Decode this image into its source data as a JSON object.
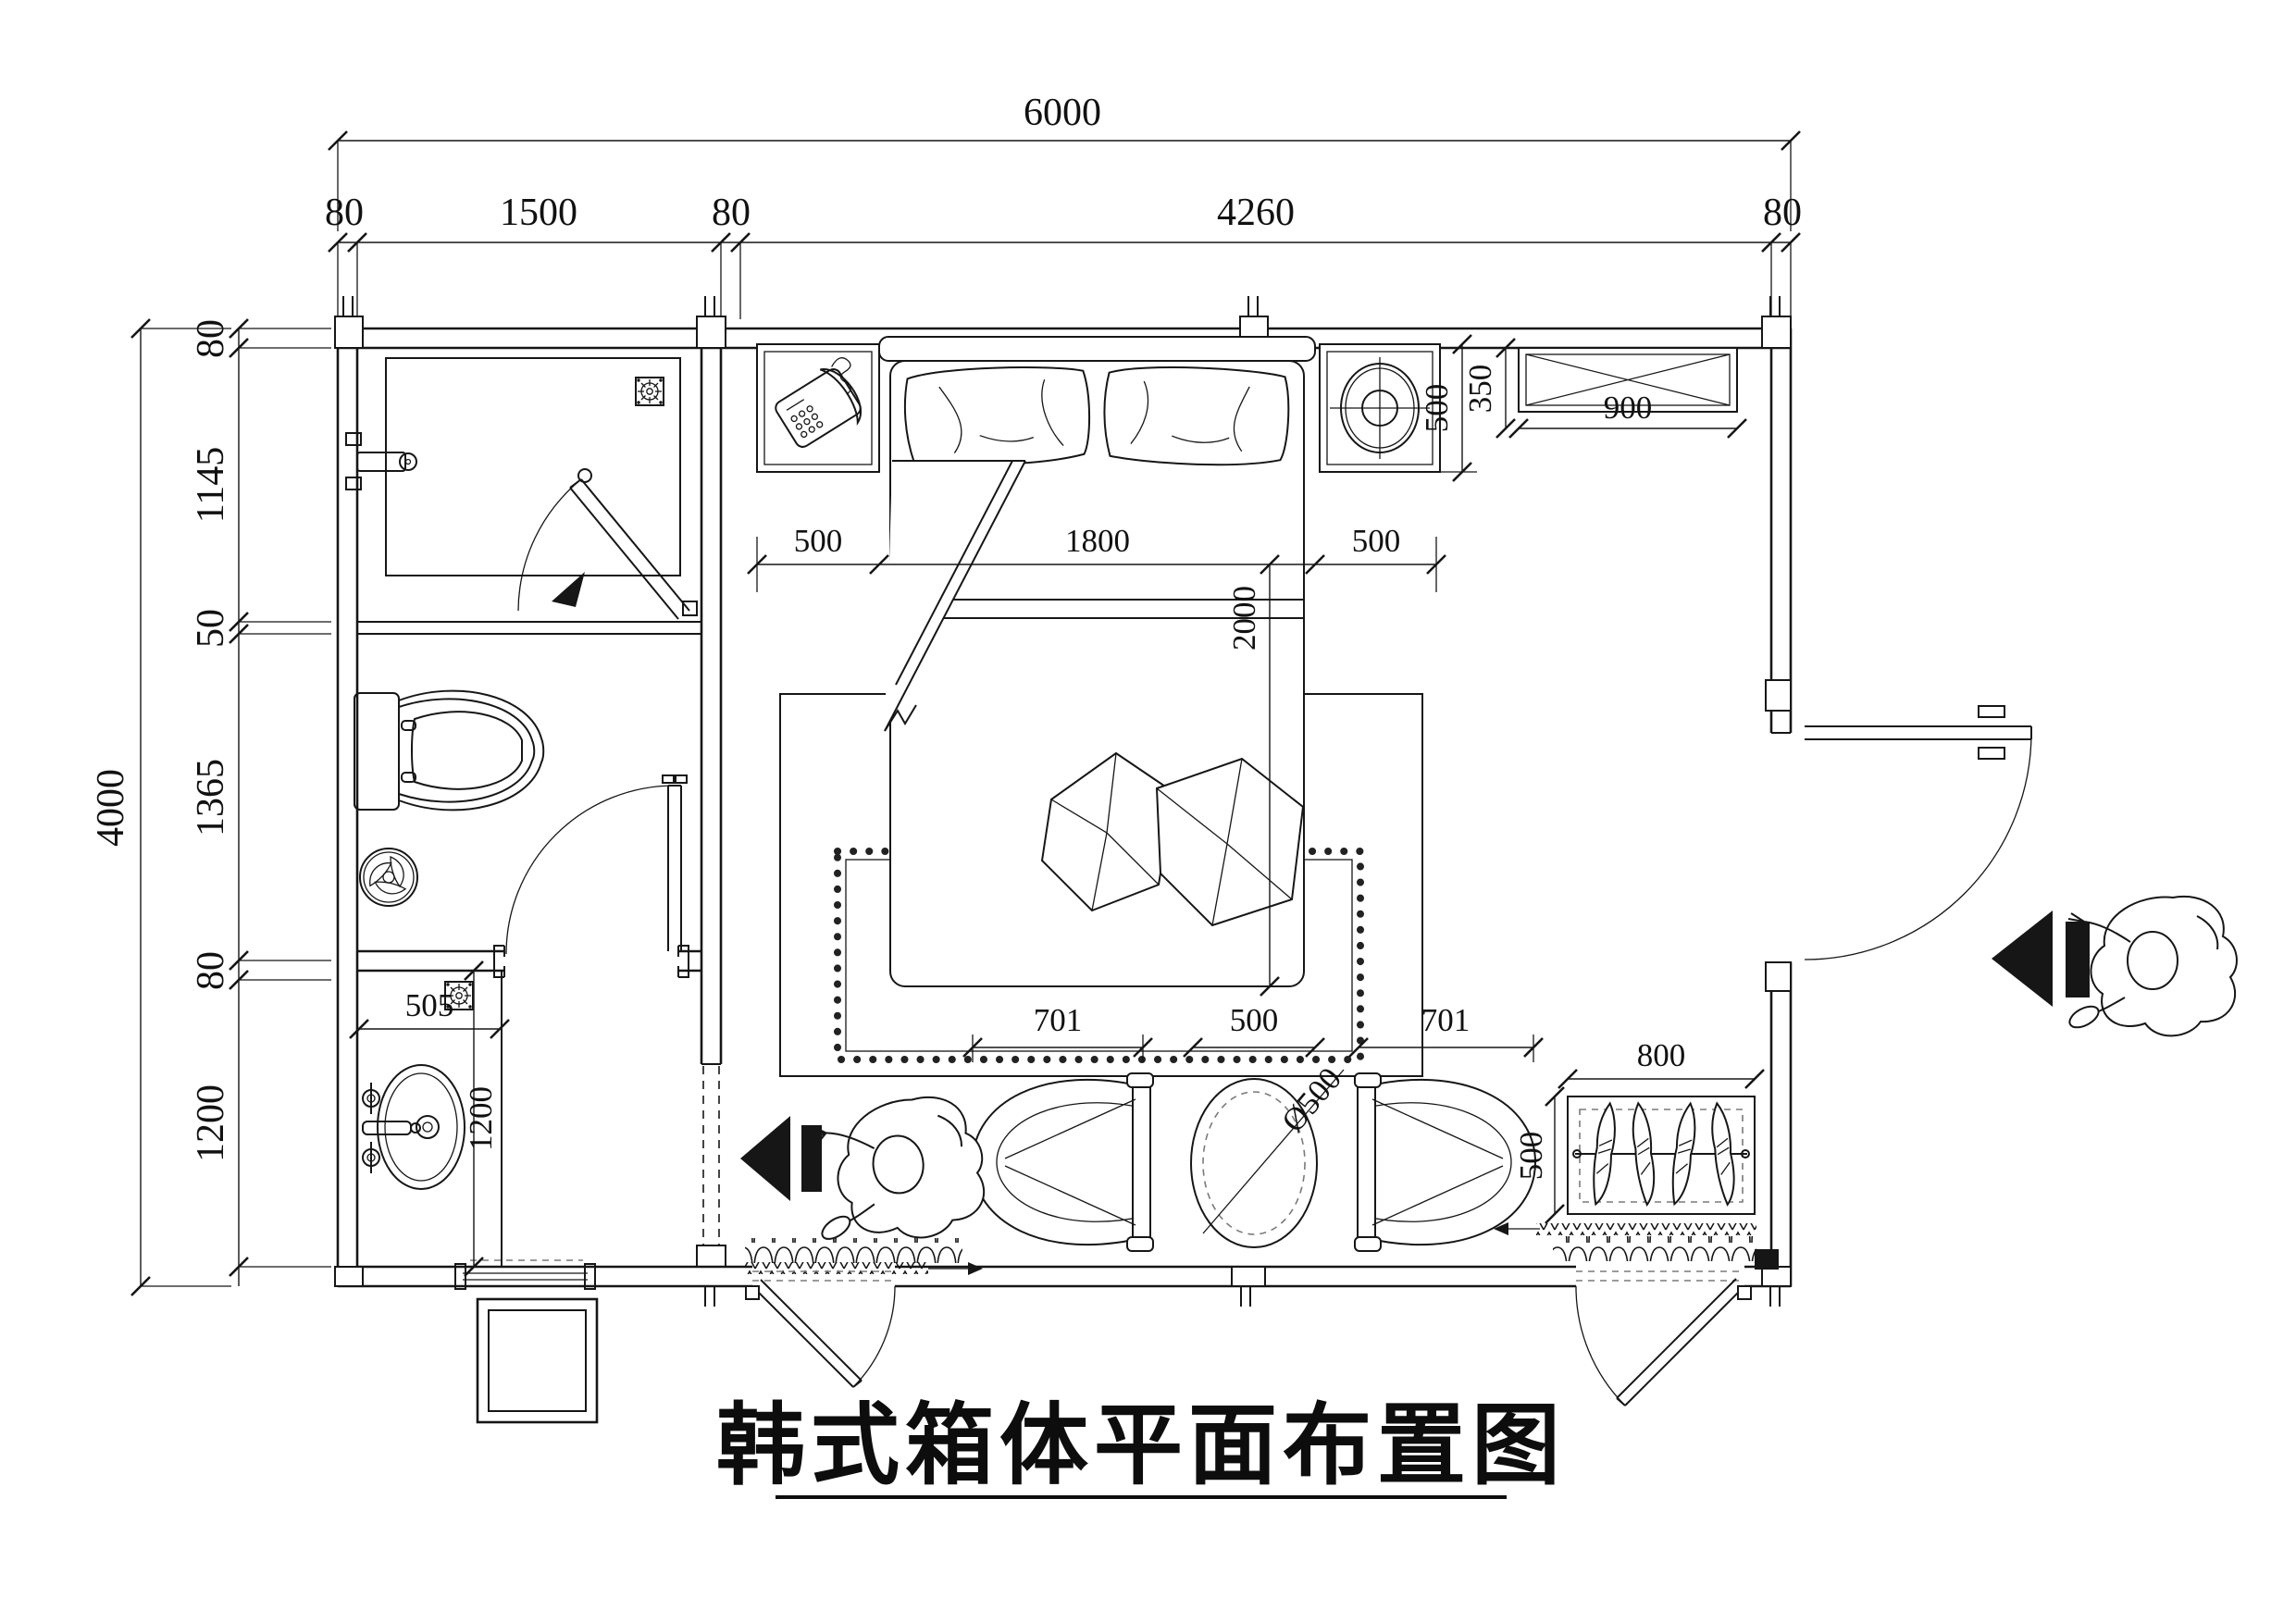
{
  "title": {
    "text": "韩式箱体平面布置图"
  },
  "dimensions": {
    "top": {
      "total": "6000",
      "segments": [
        "80",
        "1500",
        "80",
        "4260",
        "80"
      ]
    },
    "left": {
      "total": "4000",
      "segments": [
        "80",
        "1145",
        "50",
        "1365",
        "80",
        "1200"
      ]
    },
    "bed": {
      "left_gap": "500",
      "width": "1800",
      "right_gap": "500",
      "length": "2000"
    },
    "nightstand_depth": "500",
    "cabinet": {
      "depth": "350",
      "width": "900"
    },
    "vanity": {
      "width": "505",
      "depth": "1200"
    },
    "seating": {
      "left_chair": "701",
      "center_gap": "500",
      "right_chair": "701",
      "table_diameter": "Ø500"
    },
    "wardrobe": {
      "width": "800",
      "depth": "500"
    }
  }
}
